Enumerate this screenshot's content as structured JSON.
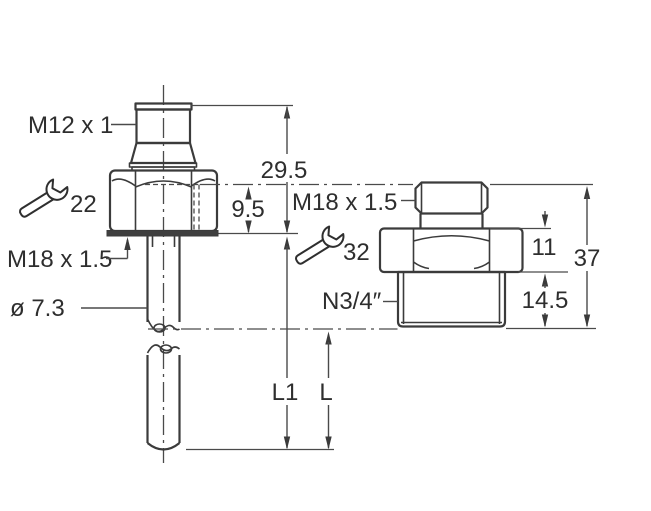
{
  "figure": {
    "background": "#ffffff",
    "line_color": "#3b3b3b",
    "text_color": "#2e2e2e",
    "left": {
      "connector_thread": "M12 x 1",
      "wrench_size": "22",
      "mounting_thread": "M18 x 1.5",
      "probe_diameter": "ø 7.3",
      "height_above_seat": "29.5",
      "hex_section_height": "9.5",
      "probe_length": "L1"
    },
    "right": {
      "female_thread": "M18 x 1.5",
      "wrench_size": "32",
      "process_thread": "N3/4″",
      "hex_height": "11",
      "total_height": "37",
      "thread_length": "14.5",
      "immersion_length": "L"
    }
  }
}
